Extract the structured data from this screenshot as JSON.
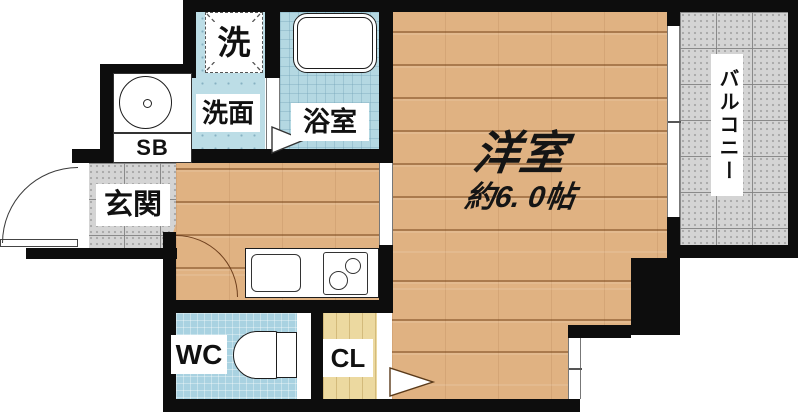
{
  "plan": {
    "labels": {
      "laundry": "洗",
      "washroom": "洗面",
      "bathroom": "浴室",
      "shoe_box": "SB",
      "entrance": "玄関",
      "toilet": "WC",
      "closet": "CL",
      "main_room": "洋室",
      "main_room_size": "約6. 0帖",
      "balcony": "バルコニー"
    },
    "colors": {
      "wall": "#0d0d0d",
      "wood_floor": "#e0b282",
      "wet_area_blue": "#b6d9e2",
      "tile_gray": "#d4d4d4",
      "closet_wood": "#ecd9a0",
      "fixture_white": "#ffffff"
    }
  }
}
